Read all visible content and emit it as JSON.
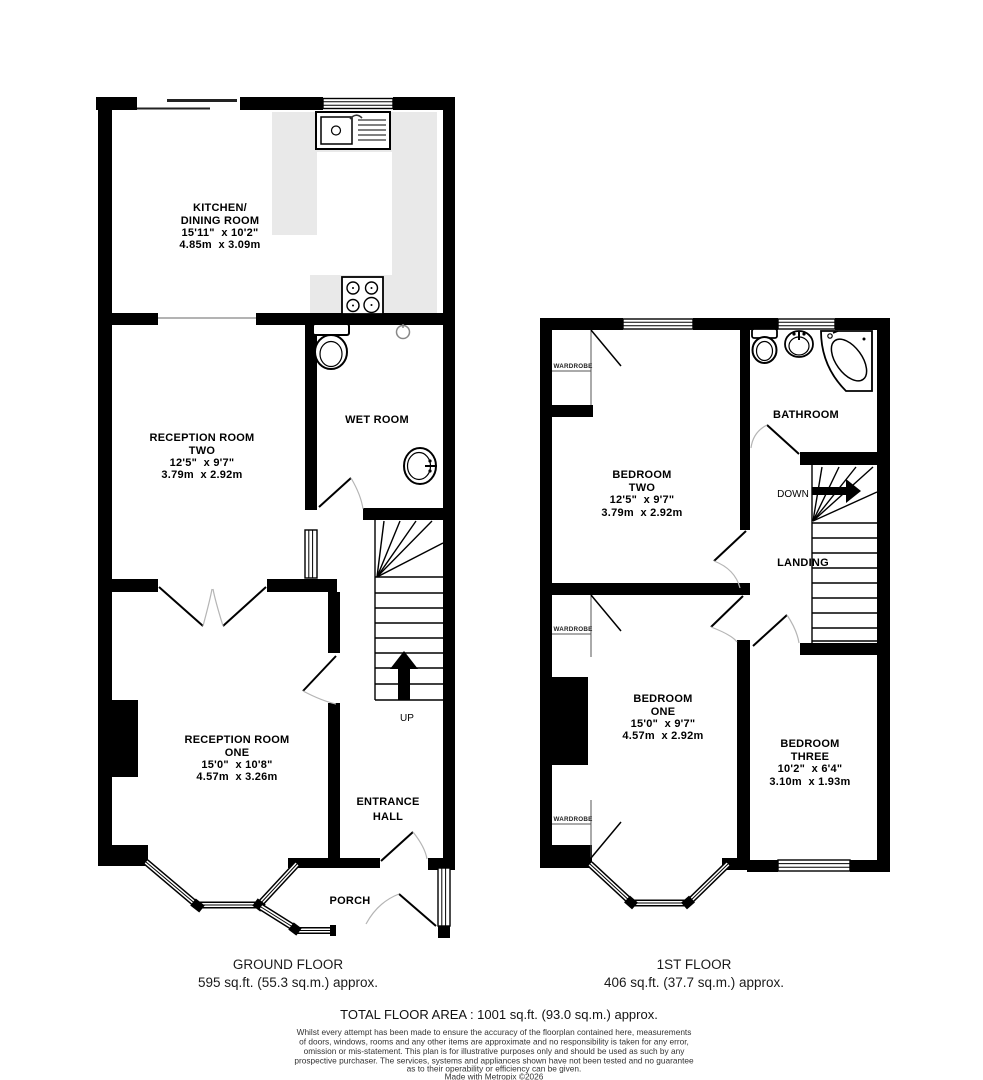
{
  "ground_floor": {
    "rooms": {
      "kitchen": {
        "name1": "KITCHEN/",
        "name2": "DINING ROOM",
        "dims_ft": "15'11\"  x 10'2\"",
        "dims_m": "4.85m  x 3.09m"
      },
      "reception_two": {
        "name1": "RECEPTION ROOM",
        "name2": "TWO",
        "dims_ft": "12'5\"  x 9'7\"",
        "dims_m": "3.79m  x 2.92m"
      },
      "wet_room": {
        "name": "WET ROOM"
      },
      "reception_one": {
        "name1": "RECEPTION ROOM",
        "name2": "ONE",
        "dims_ft": "15'0\"  x 10'8\"",
        "dims_m": "4.57m  x 3.26m"
      },
      "entrance_hall": {
        "name1": "ENTRANCE",
        "name2": "HALL"
      },
      "porch": {
        "name": "PORCH"
      },
      "stairs": {
        "direction": "UP"
      }
    },
    "caption": {
      "title": "GROUND FLOOR",
      "area": "595 sq.ft. (55.3 sq.m.) approx."
    }
  },
  "first_floor": {
    "rooms": {
      "bedroom_two": {
        "name1": "BEDROOM",
        "name2": "TWO",
        "dims_ft": "12'5\"  x 9'7\"",
        "dims_m": "3.79m  x 2.92m"
      },
      "bathroom": {
        "name": "BATHROOM"
      },
      "landing": {
        "name": "LANDING"
      },
      "bedroom_one": {
        "name1": "BEDROOM",
        "name2": "ONE",
        "dims_ft": "15'0\"  x 9'7\"",
        "dims_m": "4.57m  x 2.92m"
      },
      "bedroom_three": {
        "name1": "BEDROOM",
        "name2": "THREE",
        "dims_ft": "10'2\"  x 6'4\"",
        "dims_m": "3.10m  x 1.93m"
      },
      "stairs": {
        "direction": "DOWN"
      },
      "wardrobe_label": "WARDROBE"
    },
    "caption": {
      "title": "1ST FLOOR",
      "area": "406 sq.ft. (37.7 sq.m.) approx."
    }
  },
  "footer": {
    "total_area": "TOTAL FLOOR AREA : 1001 sq.ft. (93.0 sq.m.) approx.",
    "disclaimer_lines": [
      "Whilst every attempt has been made to ensure the accuracy of the floorplan contained here, measurements",
      "of doors, windows, rooms and any other items are approximate and no responsibility is taken for any error,",
      "omission or mis-statement. This plan is for illustrative purposes only and should be used as such by any",
      "prospective purchaser. The services, systems and appliances shown have not been tested and no guarantee",
      "as to their operability or efficiency can be given."
    ],
    "credit": "Made with Metropix ©2026"
  },
  "colors": {
    "wall": "#000000",
    "counter": "#e9e9e9",
    "door_arc": "#b5b5b5"
  }
}
